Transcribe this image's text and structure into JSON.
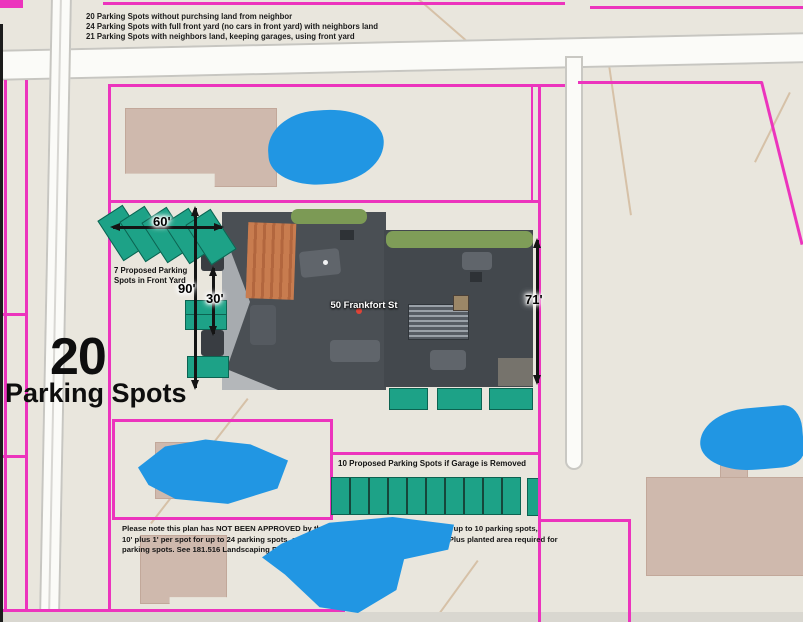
{
  "options_list": {
    "items": [
      "20 Parking Spots without purchsing land from neighbor",
      "24 Parking Spots with full front yard (no cars in front yard) with neighbors land",
      "21 Parking Spots with neighbors land, keeping garages, using front yard"
    ]
  },
  "headline": {
    "count": "20",
    "label": "Parking Spots"
  },
  "street": {
    "label": "50 Frankfort St"
  },
  "annotations": {
    "front_yard_label_line1": "7 Proposed Parking",
    "front_yard_label_line2": "Spots in Front Yard",
    "garage_removed_label": "10 Proposed Parking Spots if Garage is Removed",
    "dimensions": {
      "front_width": "60'",
      "lot_depth": "90'",
      "rear_setback": "30'",
      "building_depth": "71'"
    },
    "stall_counts": {
      "angled_front_yard": 5,
      "garage_removed_row": 10
    }
  },
  "note": {
    "lines": [
      "Please note this plan has NOT BEEN APPROVED by the City.  The set back rules are 10' for up to 10 parking spots,",
      "10' plus 1' per spot for up to 24 parking spots, and 25' offset for additional parking spots.  Plus planted area required for",
      "parking spots.  See 181.516 Landscaping Requirements for Parking Area."
    ]
  },
  "colors": {
    "parcel_line": "#ec34bd",
    "parking_spot_green": "#1da287",
    "tree_marker_blue": "#2196e3",
    "map_background": "#e9e6dd"
  }
}
